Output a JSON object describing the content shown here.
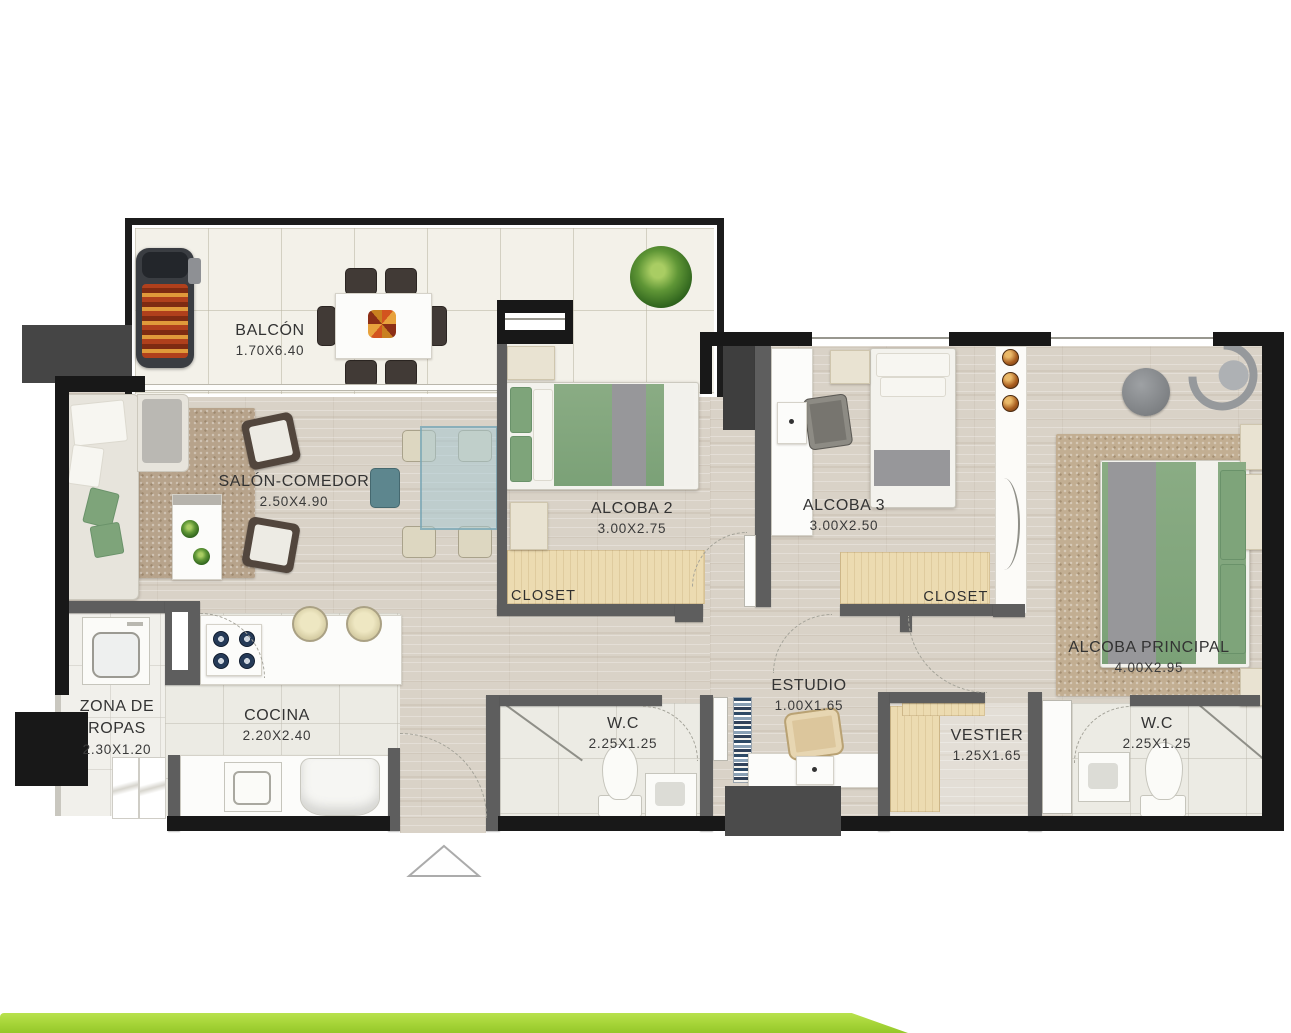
{
  "plan": {
    "type": "apartment-floor-plan",
    "rooms": [
      {
        "id": "balcon",
        "name": "BALCÓN",
        "dims": "1.70X6.40"
      },
      {
        "id": "salon",
        "name": "SALÓN-COMEDOR",
        "dims": "2.50X4.90"
      },
      {
        "id": "alcoba2",
        "name": "ALCOBA 2",
        "dims": "3.00X2.75"
      },
      {
        "id": "alcoba3",
        "name": "ALCOBA 3",
        "dims": "3.00X2.50"
      },
      {
        "id": "principal",
        "name": "ALCOBA PRINCIPAL",
        "dims": "4.00X2.95"
      },
      {
        "id": "zona-ropas",
        "name": "ZONA DE ROPAS",
        "dims": "2.30X1.20"
      },
      {
        "id": "cocina",
        "name": "COCINA",
        "dims": "2.20X2.40"
      },
      {
        "id": "wc-1",
        "name": "W.C",
        "dims": "2.25X1.25"
      },
      {
        "id": "estudio",
        "name": "ESTUDIO",
        "dims": "1.00X1.65"
      },
      {
        "id": "vestier",
        "name": "VESTIER",
        "dims": "1.25X1.65"
      },
      {
        "id": "wc-2",
        "name": "W.C",
        "dims": "2.25X1.25"
      }
    ],
    "labels": {
      "closet_alcoba2": "CLOSET",
      "closet_alcoba3": "CLOSET"
    },
    "colors": {
      "accent_bar": "#a5d437",
      "wall_exterior": "#181818",
      "wall_interior": "#5e5e5e",
      "closet_fill": "#ecdbb1",
      "bedding_green": "#7ea47a",
      "wood_floor": "#d9d2c7",
      "balcony_floor": "#f3f1e9"
    }
  }
}
